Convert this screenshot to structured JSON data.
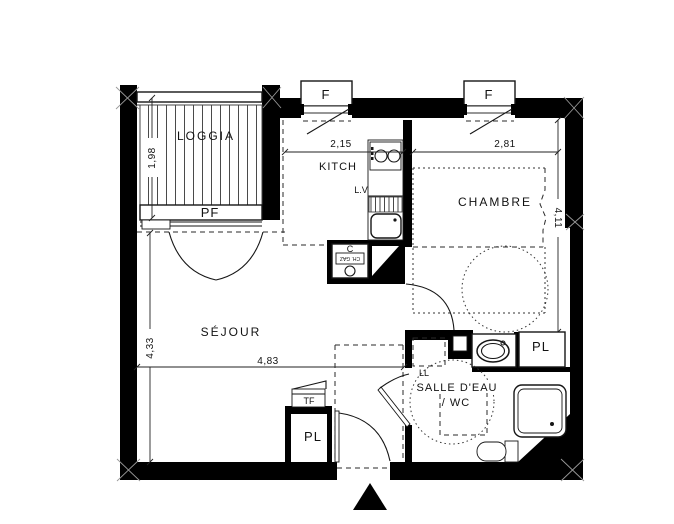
{
  "title": "Apartment floor plan",
  "rooms": {
    "loggia": "LOGGIA",
    "kitchen": "KITCH",
    "bedroom": "CHAMBRE",
    "living": "SÉJOUR",
    "bathroom_line1": "SALLE D'EAU",
    "bathroom_line2": "/ WC",
    "closet_bath": "PL",
    "closet_entry": "PL"
  },
  "openings": {
    "window1": "F",
    "window2": "F",
    "french_window": "PF"
  },
  "equipment": {
    "dishwasher": "L.V",
    "washing_machine": "LL",
    "boiler": "C",
    "boiler_type": "CH. GAZ",
    "electrical_panel": "TF"
  },
  "dimensions": {
    "loggia_width": "1,98",
    "kitchen_width": "2,15",
    "bedroom_width": "2,81",
    "bedroom_depth": "4,11",
    "living_depth": "4,33",
    "living_width": "4,83"
  },
  "colors": {
    "wall": "#000000",
    "line": "#1c1c1c",
    "background": "#ffffff"
  }
}
